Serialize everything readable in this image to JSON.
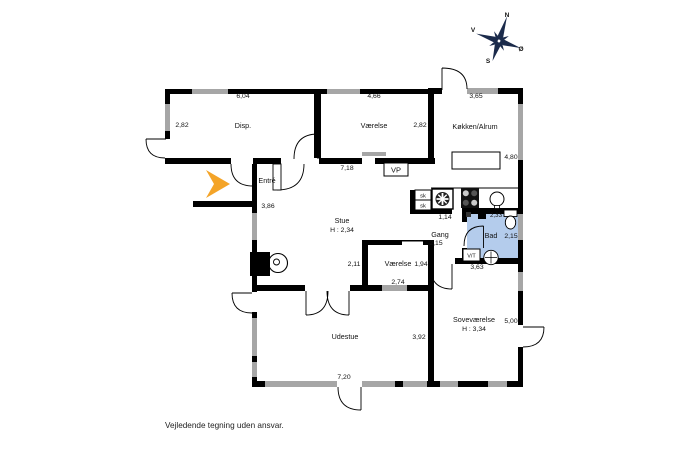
{
  "rooms": {
    "disp": "Disp.",
    "vaerelse_top": "Værelse",
    "koekken": "Køkken/Alrum",
    "entre": "Entré",
    "stue": "Stue",
    "stue_height": "H : 2,34",
    "gang": "Gang",
    "bad": "Bad",
    "vaerelse_mid": "Værelse",
    "udestue": "Udestue",
    "sovevaerelse": "Soveværelse",
    "sove_height": "H : 3,34"
  },
  "dims": {
    "disp_w": "6,04",
    "disp_d": "2,82",
    "vaer1_w": "4,66",
    "vaer1_d": "2,82",
    "koekken_w": "3,65",
    "koekken_d": "4,80",
    "stue_w": "7,18",
    "entre_wall": "3,86",
    "closet": "1,14",
    "gang_w": "2,15",
    "bad_top": "2,33",
    "bad_w": "2,15",
    "bad_bottom": "3,63",
    "vaer2_left": "2,11",
    "vaer2_w": "1,94",
    "vaer2_bottom": "2,74",
    "udestue_d": "3,92",
    "udestue_w": "7,20",
    "sove_d": "5,00"
  },
  "labels": {
    "vp": "VP",
    "vt": "V/T",
    "sk1": "sk",
    "sk2": "sk",
    "disclaimer": "Vejledende tegning uden ansvar."
  },
  "compass": {
    "n": "N",
    "e": "Ø",
    "s": "S",
    "w": "V"
  },
  "colors": {
    "wall": "#000000",
    "window": "#a6a6a6",
    "bathroom": "#b4ccec",
    "arrow": "#f4a428",
    "compass": "#1b2b4b"
  }
}
